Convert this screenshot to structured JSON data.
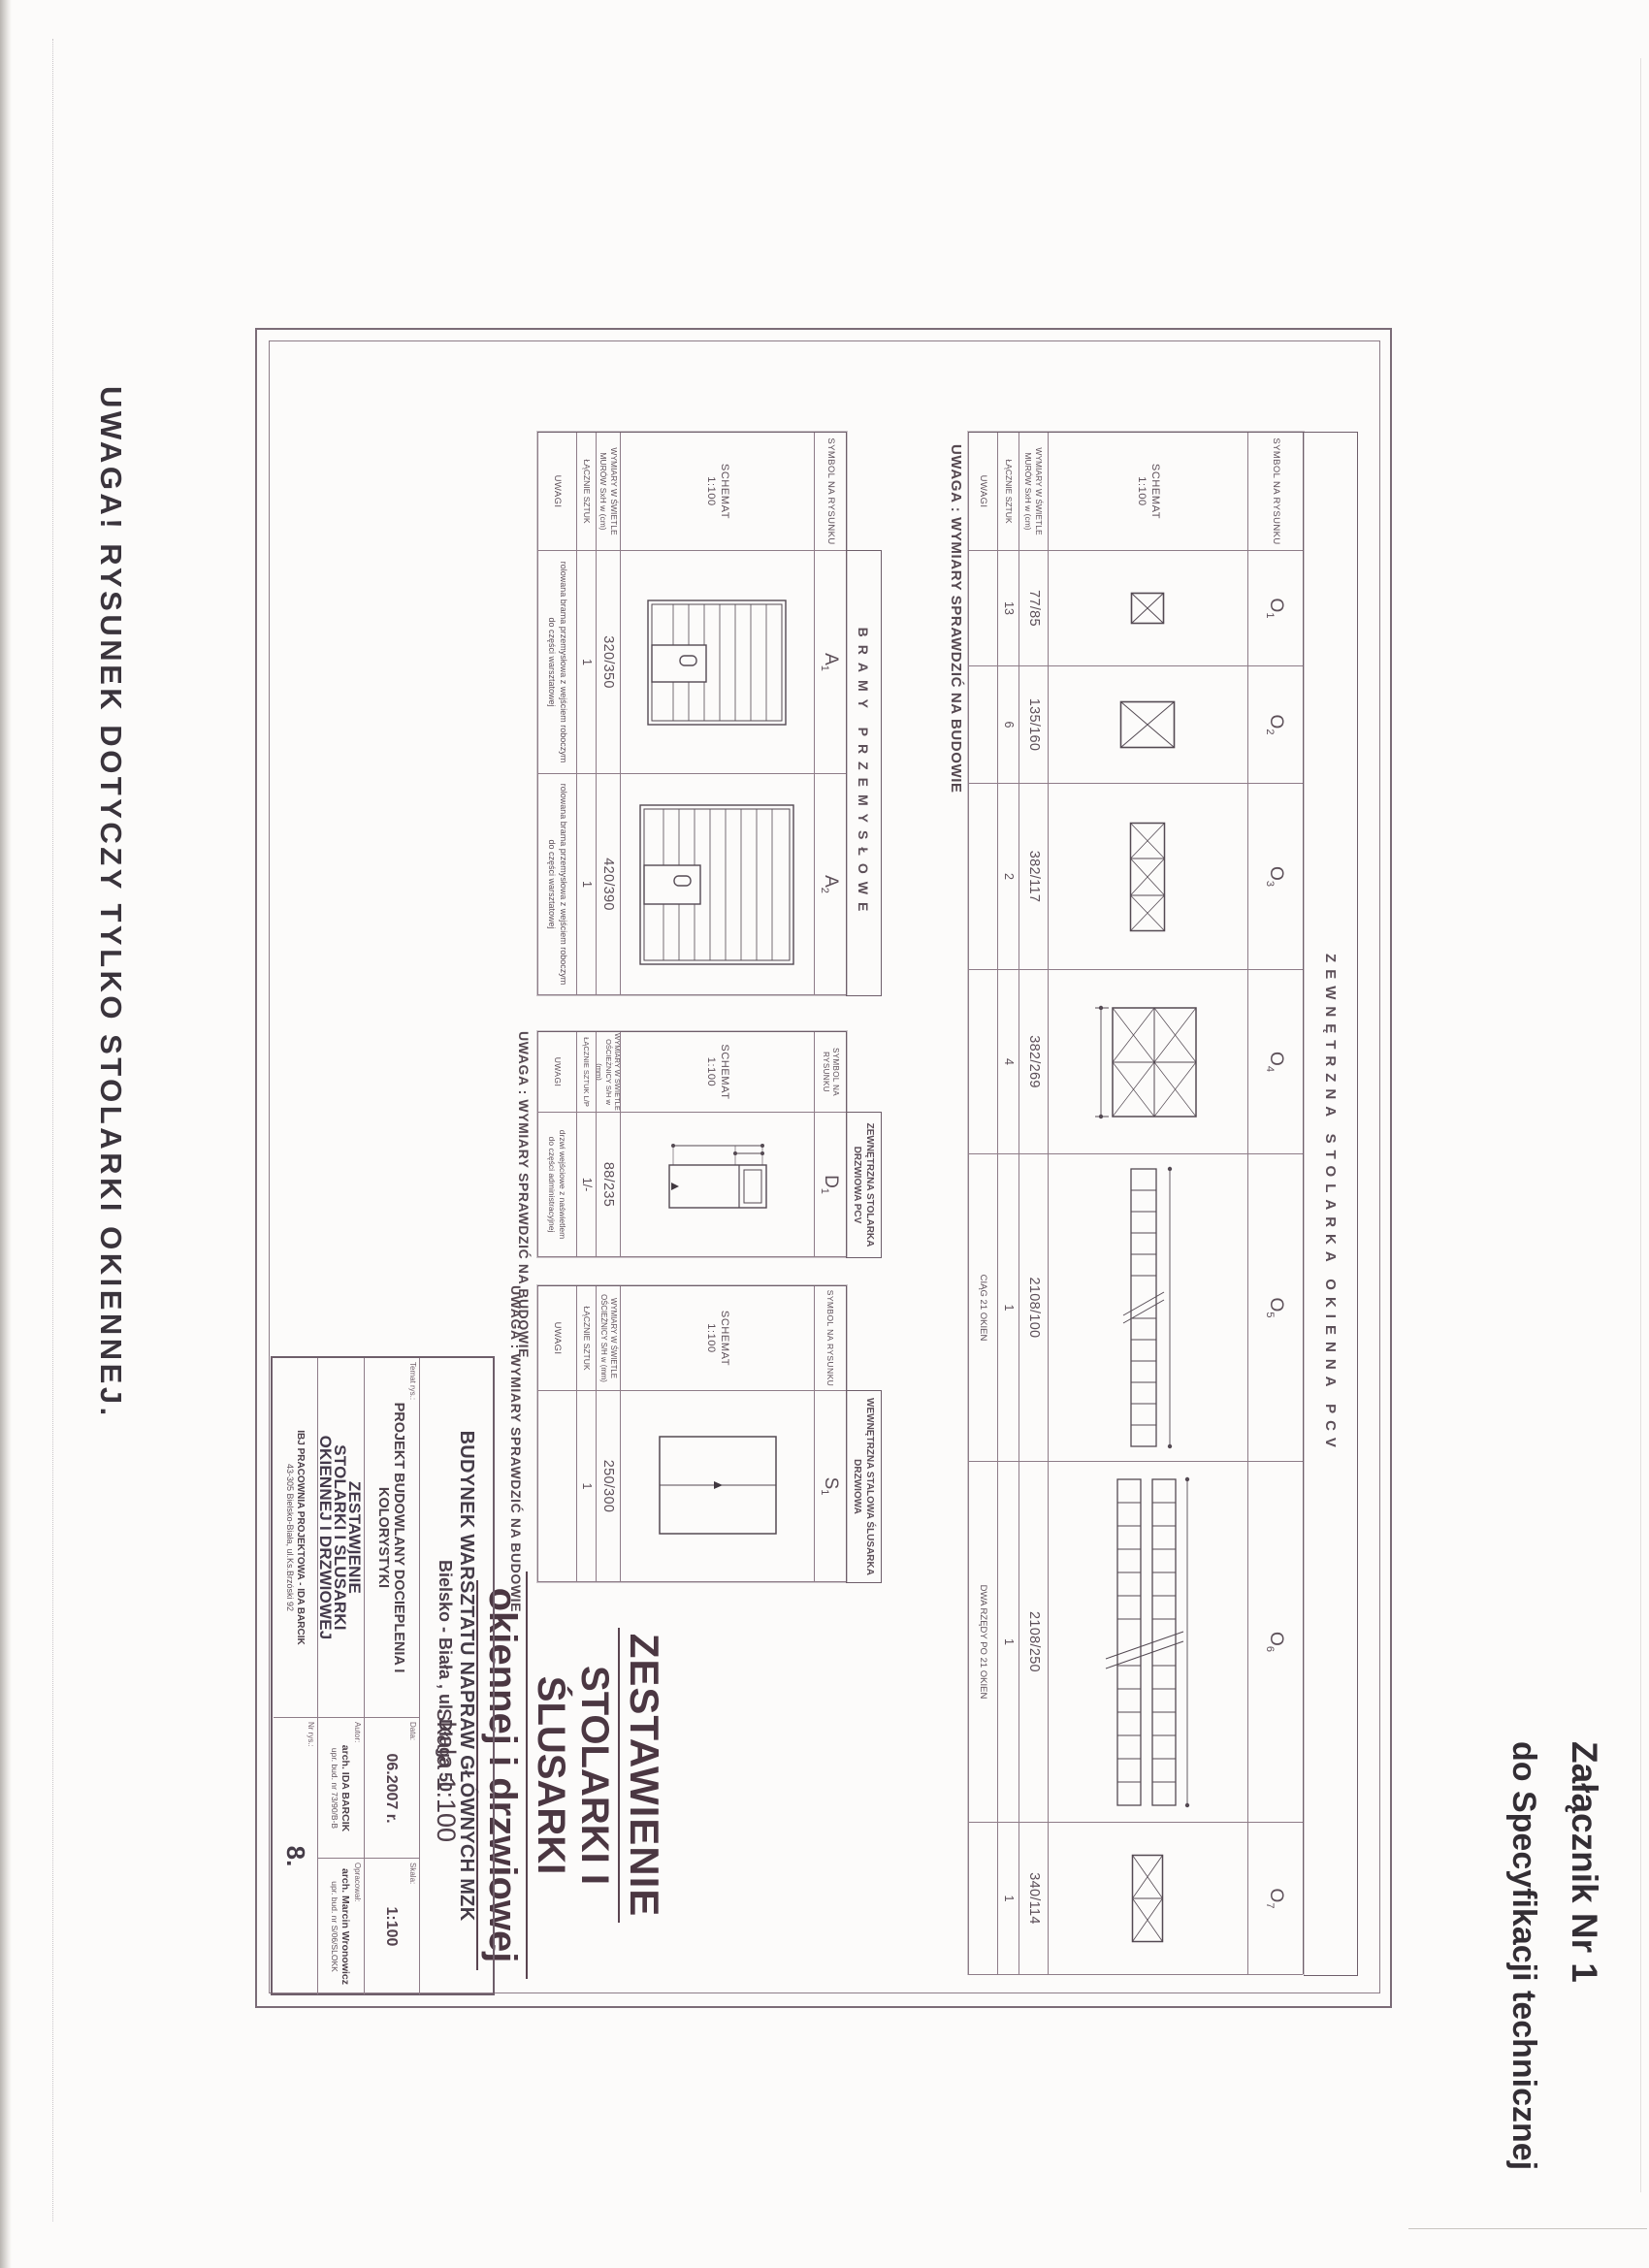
{
  "page": {
    "attachment_line1": "Załącznik Nr 1",
    "attachment_line2": "do Specyfikacji technicznej",
    "bottom_note": "UWAGA!  RYSUNEK DOTYCZY TYLKO STOLARKI OKIENNEJ."
  },
  "colors": {
    "paper": "#fcfbfa",
    "ink": "#473d47",
    "line": "#8e7c88",
    "title": "#4b3742"
  },
  "labels": {
    "symbol": "SYMBOL NA RYSUNKU",
    "schemat": "SCHEMAT",
    "scale": "1:100",
    "dims_mur_1": "WYMIARY W ŚWIETLE",
    "dims_mur_2": "MURÓW SxH w (cm)",
    "dims_osc_1": "WYMIARY W ŚWIETLE",
    "dims_osc_2": "OŚCIEŻNICY S/H w (mm)",
    "lacznie": "ŁĄCZNIE SZTUK",
    "lacznie_lp": "ŁĄCZNIE SZTUK L/P",
    "uwagi": "UWAGI",
    "site_note": "UWAGA : WYMIARY SPRAWDZIĆ NA BUDOWIE"
  },
  "windows_table": {
    "banner": "ZEWNĘTRZNA STOLARKA OKIENNA PCV",
    "columns": [
      {
        "sym": "O",
        "sub": "1",
        "dims": "77/85",
        "qty": "13",
        "note": ""
      },
      {
        "sym": "O",
        "sub": "2",
        "dims": "135/160",
        "qty": "6",
        "note": ""
      },
      {
        "sym": "O",
        "sub": "3",
        "dims": "382/117",
        "qty": "2",
        "note": ""
      },
      {
        "sym": "O",
        "sub": "4",
        "dims": "382/269",
        "qty": "4",
        "note": ""
      },
      {
        "sym": "O",
        "sub": "5",
        "dims": "2108/100",
        "qty": "1",
        "note": "CIĄG 21 OKIEN"
      },
      {
        "sym": "O",
        "sub": "6",
        "dims": "2108/250",
        "qty": "1",
        "note": "DWA RZĘDY PO 21 OKIEN"
      },
      {
        "sym": "O",
        "sub": "7",
        "dims": "340/114",
        "qty": "1",
        "note": ""
      }
    ]
  },
  "gates_table": {
    "banner": "BRAMY PRZEMYSŁOWE",
    "columns": [
      {
        "sym": "A",
        "sub": "1",
        "dims": "320/350",
        "qty": "1",
        "note1": "rolowana brama przemysłowa z wejściem roboczym",
        "note2": "do części warsztatowej"
      },
      {
        "sym": "A",
        "sub": "2",
        "dims": "420/390",
        "qty": "1",
        "note1": "rolowana brama przemysłowa z wejściem roboczym",
        "note2": "do części warsztatowej"
      }
    ]
  },
  "door_pcv_table": {
    "banner1": "ZEWNĘTRZNA STOLARKA",
    "banner2": "DRZWIOWA PCV",
    "column": {
      "sym": "D",
      "sub": "1",
      "dims": "88/235",
      "qty": "1/-",
      "note1": "drzwi wejściowe z naświetlem",
      "note2": "do części administracyjnej"
    }
  },
  "door_steel_table": {
    "banner1": "WEWNĘTRZNA STALOWA ŚLUSARKA",
    "banner2": "DRZWIOWA",
    "column": {
      "sym": "S",
      "sub": "1",
      "dims": "250/300",
      "qty": "1",
      "note1": "",
      "note2": ""
    }
  },
  "main_title": {
    "line1": "ZESTAWIENIE",
    "line2": "STOLARKI I ŚLUSARKI",
    "line3": "okiennej i drzwiowej",
    "scale": "skala  1:100"
  },
  "title_block": {
    "object1": "BUDYNEK WARSZTATU NAPRAW GŁÓWNYCH MZK",
    "object2": "Bielsko - Biała , ul. Długa 50",
    "temat_label": "Temat rys.:",
    "project": "PROJEKT BUDOWLANY DOCIEPLENIA I KOLORYSTYKI",
    "data_label": "Data:",
    "data_value": "06.2007 r.",
    "skala_label": "Skala:",
    "skala_value": "1:100",
    "title1": "ZESTAWIENIE",
    "title2": "STOLARKI I ŚLUSARKI",
    "title3": "OKIENNEJ I DRZWIOWEJ",
    "autor_label": "Autor:",
    "autor1": "arch. IDA BARCIK",
    "autor2": "upr. bud. nr 73/90/B-B",
    "oprac_label": "Opracował:",
    "oprac1": "arch. Marcin Wronowicz",
    "oprac2": "upr. bud. nr S/06/SLOKK",
    "office1": "IBJ PRACOWNIA PROJEKTOWA - IDA BARCIK",
    "office2": "43-305 Bielsko-Biała, ul.Ks.Brzóski 92",
    "nr_label": "Nr rys.:",
    "nr_value": "8."
  }
}
